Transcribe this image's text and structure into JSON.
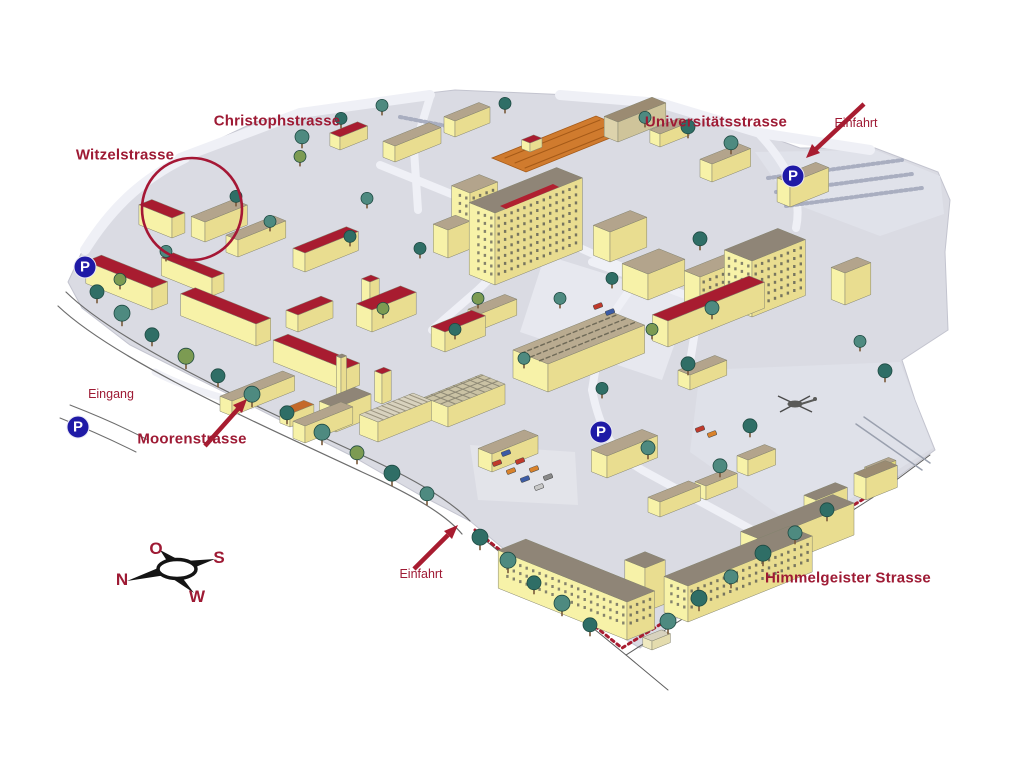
{
  "map": {
    "kind": "illustrated isometric campus map",
    "streets": {
      "christophstrasse": "Christophstrasse",
      "witzelstrasse": "Witzelstrasse",
      "universitaetsstrasse": "Universitätsstrasse",
      "moorenstrasse": "Moorenstrasse",
      "himmelgeister_strasse": "Himmelgeister Strasse"
    },
    "entrances": {
      "einfahrt_north": "Einfahrt",
      "einfahrt_south": "Einfahrt",
      "eingang": "Eingang"
    },
    "parking": {
      "symbol": "P"
    },
    "compass": {
      "top": "O",
      "right": "S",
      "left": "N",
      "bottom": "W"
    },
    "highlight": {
      "type": "circle",
      "near": "Witzelstrasse"
    },
    "colors": {
      "label_red": "#9e1a34",
      "roof_red": "#a81c30",
      "parking_blue": "#1f1aa6",
      "building_yellow": "#f7f2a8",
      "ground_gray": "#dadbe3",
      "tree_teal": "#2f6e66"
    }
  }
}
